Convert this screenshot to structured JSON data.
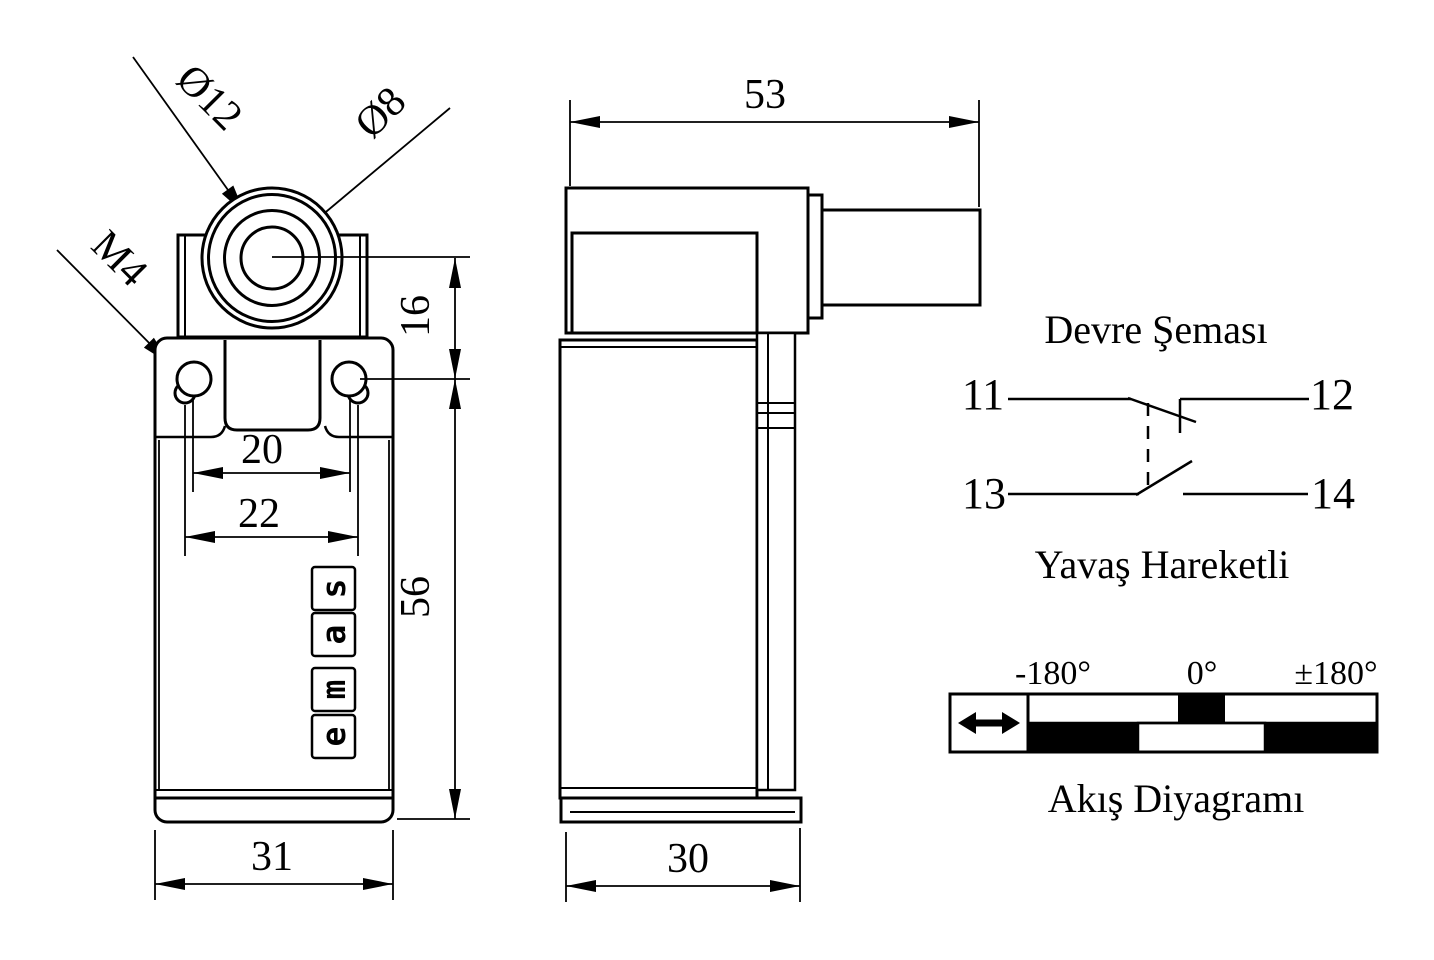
{
  "front": {
    "dia12": "Ø12",
    "dia8": "Ø8",
    "thread": "M4",
    "d16": "16",
    "d20": "20",
    "d22": "22",
    "d56": "56",
    "d31": "31",
    "logo": [
      "s",
      "a",
      "m",
      "e"
    ]
  },
  "side": {
    "d53": "53",
    "d30": "30"
  },
  "circuit": {
    "title": "Devre Şeması",
    "t11": "11",
    "t12": "12",
    "t13": "13",
    "t14": "14",
    "subtitle": "Yavaş Hareketli"
  },
  "flow": {
    "neg": "-180°",
    "zero": "0°",
    "pos": "±180°",
    "title": "Akış Diyagramı"
  }
}
